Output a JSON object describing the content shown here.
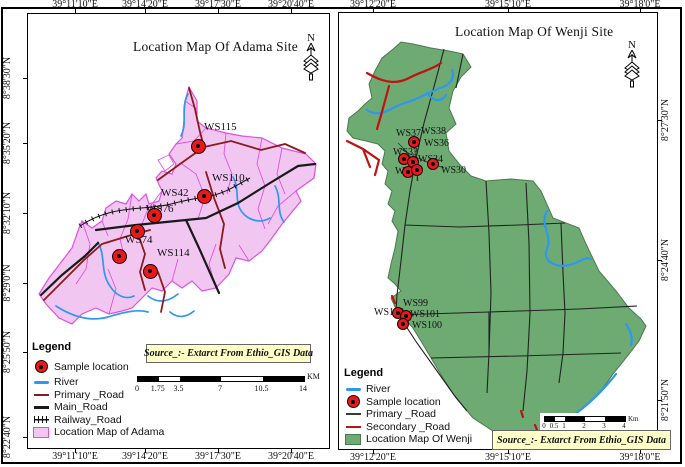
{
  "colors": {
    "adama_fill": "#f1c7f1",
    "adama_border": "#e050e0",
    "wenji_fill": "#6dab72",
    "wenji_border": "#4a7a50",
    "river": "#2e97f2",
    "primary_road_adama": "#8b1a1a",
    "main_road": "#1a1a1a",
    "primary_road_wenji": "#3a3a3a",
    "secondary_road": "#c01212",
    "sample_dot": "#e8191a",
    "source_bg": "#ffffc8"
  },
  "adama": {
    "title": "Location Map Of Adama Site",
    "north_label": "N",
    "lon_ticks": [
      {
        "label": "39°11'10\"E",
        "x": 75
      },
      {
        "label": "39°14'20\"E",
        "x": 145
      },
      {
        "label": "39°17'30\"E",
        "x": 218
      },
      {
        "label": "39°20'40\"E",
        "x": 291
      }
    ],
    "lat_ticks": [
      {
        "label": "8°38'30\"N",
        "y": 78
      },
      {
        "label": "8°35'20\"N",
        "y": 143
      },
      {
        "label": "8°32'10\"N",
        "y": 213
      },
      {
        "label": "8°29'0\"N",
        "y": 283
      },
      {
        "label": "8°25'50\"N",
        "y": 352
      },
      {
        "label": "8°22'40\"N",
        "y": 437
      }
    ],
    "sample_dots": [
      [
        198,
        146
      ],
      [
        204,
        196
      ],
      [
        154,
        215
      ],
      [
        137,
        231
      ],
      [
        119,
        256
      ],
      [
        150,
        271
      ]
    ],
    "sample_labels": [
      {
        "text": "WS115",
        "x": 204,
        "y": 121
      },
      {
        "text": "WS110",
        "x": 212,
        "y": 172
      },
      {
        "text": "WS42",
        "x": 161,
        "y": 187
      },
      {
        "text": "WS76",
        "x": 146,
        "y": 203
      },
      {
        "text": "WS74",
        "x": 125,
        "y": 234
      },
      {
        "text": "WS114",
        "x": 157,
        "y": 247
      }
    ],
    "legend": {
      "header": "Legend",
      "items": [
        {
          "symbol": "sample-dot",
          "label": "Sample location"
        },
        {
          "symbol": "river",
          "label": "River"
        },
        {
          "symbol": "primary-road-adama",
          "label": "Primary _Road"
        },
        {
          "symbol": "main-road",
          "label": "Main_Road"
        },
        {
          "symbol": "railway-road",
          "label": "Railway_Road"
        },
        {
          "symbol": "adama-fill",
          "label": "Location Map of Adama"
        }
      ]
    },
    "scalebar": {
      "values": [
        0,
        1.75,
        3.5,
        7,
        10.5,
        14
      ],
      "labels": [
        "0",
        "1.75",
        "3.5",
        "7",
        "10.5",
        "14"
      ],
      "unit": "KM"
    },
    "source_note": "Source_:- Extarct From Ethio_GIS Data"
  },
  "wenji": {
    "title": "Location Map Of Wenji Site",
    "north_label": "N",
    "lon_ticks": [
      {
        "label": "39°12'20\"E",
        "x": 373
      },
      {
        "label": "39°15'10\"E",
        "x": 508
      },
      {
        "label": "39°18'0\"E",
        "x": 640
      }
    ],
    "lat_ticks": [
      {
        "label": "8°27'30\"N",
        "y": 120
      },
      {
        "label": "8°24'40\"N",
        "y": 260
      },
      {
        "label": "8°21'50\"N",
        "y": 400
      }
    ],
    "sample_dots": [
      [
        414,
        142
      ],
      [
        404,
        159
      ],
      [
        413,
        162
      ],
      [
        433,
        164
      ],
      [
        408,
        172
      ],
      [
        417,
        170
      ],
      [
        398,
        313
      ],
      [
        406,
        316
      ],
      [
        403,
        324
      ]
    ],
    "sample_labels": [
      {
        "text": "WS37",
        "x": 396,
        "y": 128
      },
      {
        "text": "WS38",
        "x": 421,
        "y": 126
      },
      {
        "text": "WS36",
        "x": 424,
        "y": 138
      },
      {
        "text": "WS33",
        "x": 393,
        "y": 147
      },
      {
        "text": "WS34",
        "x": 418,
        "y": 154
      },
      {
        "text": "WS31",
        "x": 395,
        "y": 166
      },
      {
        "text": "WS30",
        "x": 441,
        "y": 165
      },
      {
        "text": "WS99",
        "x": 403,
        "y": 298
      },
      {
        "text": "WS102",
        "x": 374,
        "y": 307
      },
      {
        "text": "WS101",
        "x": 410,
        "y": 309
      },
      {
        "text": "WS100",
        "x": 412,
        "y": 320
      }
    ],
    "legend": {
      "header": "Legend",
      "items": [
        {
          "symbol": "river",
          "label": "River"
        },
        {
          "symbol": "sample-dot",
          "label": "Sample location"
        },
        {
          "symbol": "primary-road-wenji",
          "label": "Primary _Road"
        },
        {
          "symbol": "secondary-road",
          "label": "Secondary _Road"
        },
        {
          "symbol": "wenji-fill",
          "label": "Location Map Of Wenji"
        }
      ]
    },
    "scalebar": {
      "values": [
        0,
        0.5,
        1,
        2,
        3,
        4
      ],
      "labels": [
        "0",
        "0.5",
        "1",
        "2",
        "3",
        "4"
      ],
      "unit": "Km"
    },
    "source_note": "Source_:- Extarct From Ethio_GIS Data"
  }
}
